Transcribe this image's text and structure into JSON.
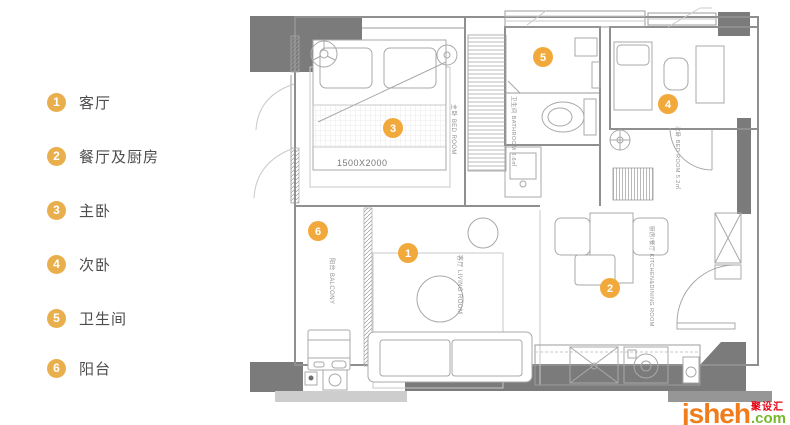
{
  "legend": {
    "items": [
      {
        "num": "1",
        "label": "客厅"
      },
      {
        "num": "2",
        "label": "餐厅及厨房"
      },
      {
        "num": "3",
        "label": "主卧"
      },
      {
        "num": "4",
        "label": "次卧"
      },
      {
        "num": "5",
        "label": "卫生间"
      },
      {
        "num": "6",
        "label": "阳台"
      }
    ]
  },
  "plan": {
    "markers": [
      {
        "num": "1"
      },
      {
        "num": "2"
      },
      {
        "num": "3"
      },
      {
        "num": "4"
      },
      {
        "num": "5"
      },
      {
        "num": "6"
      }
    ],
    "labels": {
      "bed_size": "1500X2000",
      "master_bedroom": "主卧 BED ROOM",
      "second_bedroom": "次卧 BED ROOM 5.2㎡",
      "bathroom": "卫生间 BATHROOM 3.6㎡",
      "living_room": "客厅 LIVING ROOM",
      "kitchen_dining": "厨房/餐厅 KITCHEN&DINING ROOM",
      "balcony": "阳台 BALCONY"
    }
  },
  "watermark": {
    "brand": "jsheh",
    "tld": ".com",
    "cn": "聚设汇"
  },
  "colors": {
    "legend_badge": "#E9AF4D",
    "plan_marker": "#F2A93B",
    "wall_dark": "#7B7B7B",
    "brand_orange": "#F07D1C",
    "brand_green": "#76B82A",
    "brand_red": "#E60012"
  }
}
